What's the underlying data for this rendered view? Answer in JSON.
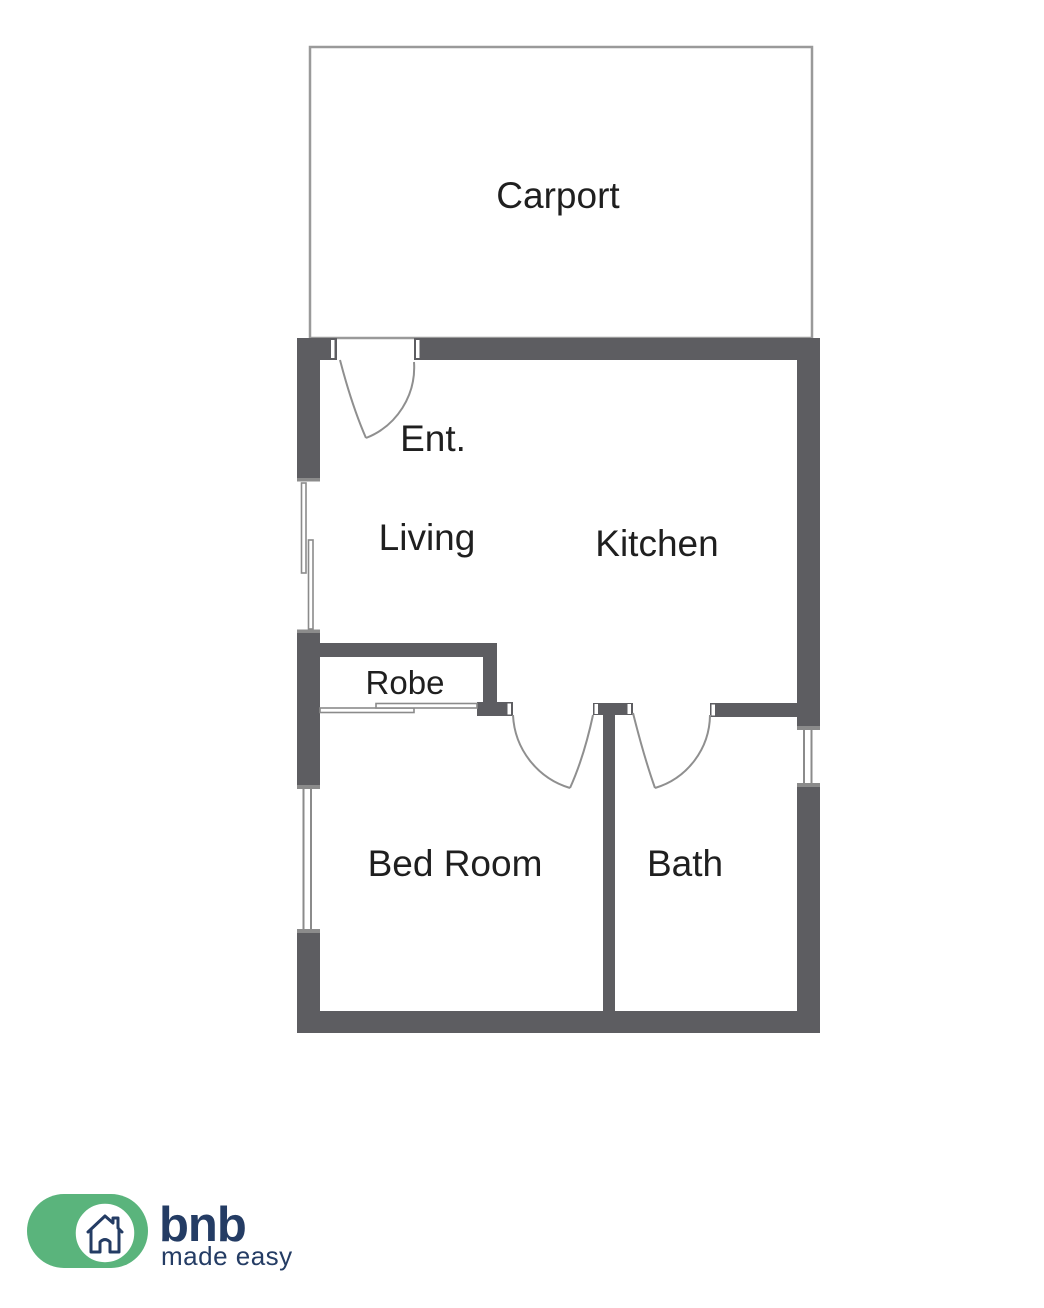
{
  "page": {
    "title": "Floor plan"
  },
  "colors": {
    "wall": "#5d5d61",
    "thin_line": "#9a9a9a",
    "door_arc": "#8f8f8f",
    "window_line": "#8b8b8b",
    "label": "#1f1f1f",
    "logo_green": "#5ab47c",
    "logo_navy": "#243c64"
  },
  "floorplan": {
    "rooms": {
      "carport": {
        "label": "Carport"
      },
      "entrance": {
        "label": "Ent."
      },
      "living": {
        "label": "Living"
      },
      "kitchen": {
        "label": "Kitchen"
      },
      "robe": {
        "label": "Robe"
      },
      "bedroom": {
        "label": "Bed Room"
      },
      "bath": {
        "label": "Bath"
      }
    }
  },
  "logo": {
    "brand": "bnb",
    "tagline": "made easy",
    "icon": "house-icon"
  }
}
